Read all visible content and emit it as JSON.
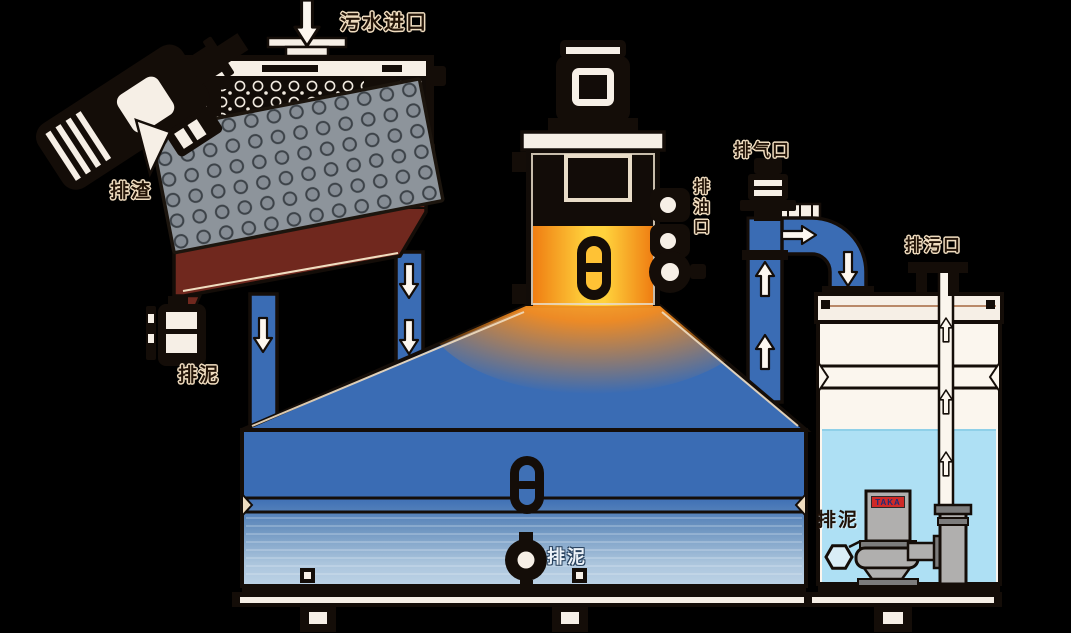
{
  "labels": {
    "inlet": "污水进口",
    "slag": "排渣",
    "sludge_left": "排泥",
    "oil_port": "排油口",
    "vent": "排气口",
    "drain": "排污口",
    "sludge_bottom": "排泥",
    "sludge_right": "排泥",
    "pump_brand": "TAKA"
  },
  "colors": {
    "background": "#000000",
    "outline": "#140d08",
    "paper_white": "#f6efe6",
    "tank_blue": "#3a6cb4",
    "tank_blue_light": "#b6cfe3",
    "hopper_maroon": "#70281e",
    "oil_orange": "#f08019",
    "oil_yellow": "#ffd23c",
    "water_light_blue": "#aee0f4",
    "plate_gray": "#8d949b",
    "pump_gray": "#b0afae",
    "brand_red": "#cf2a27",
    "label_dark": "#231408",
    "label_light": "#f0ddc0"
  }
}
